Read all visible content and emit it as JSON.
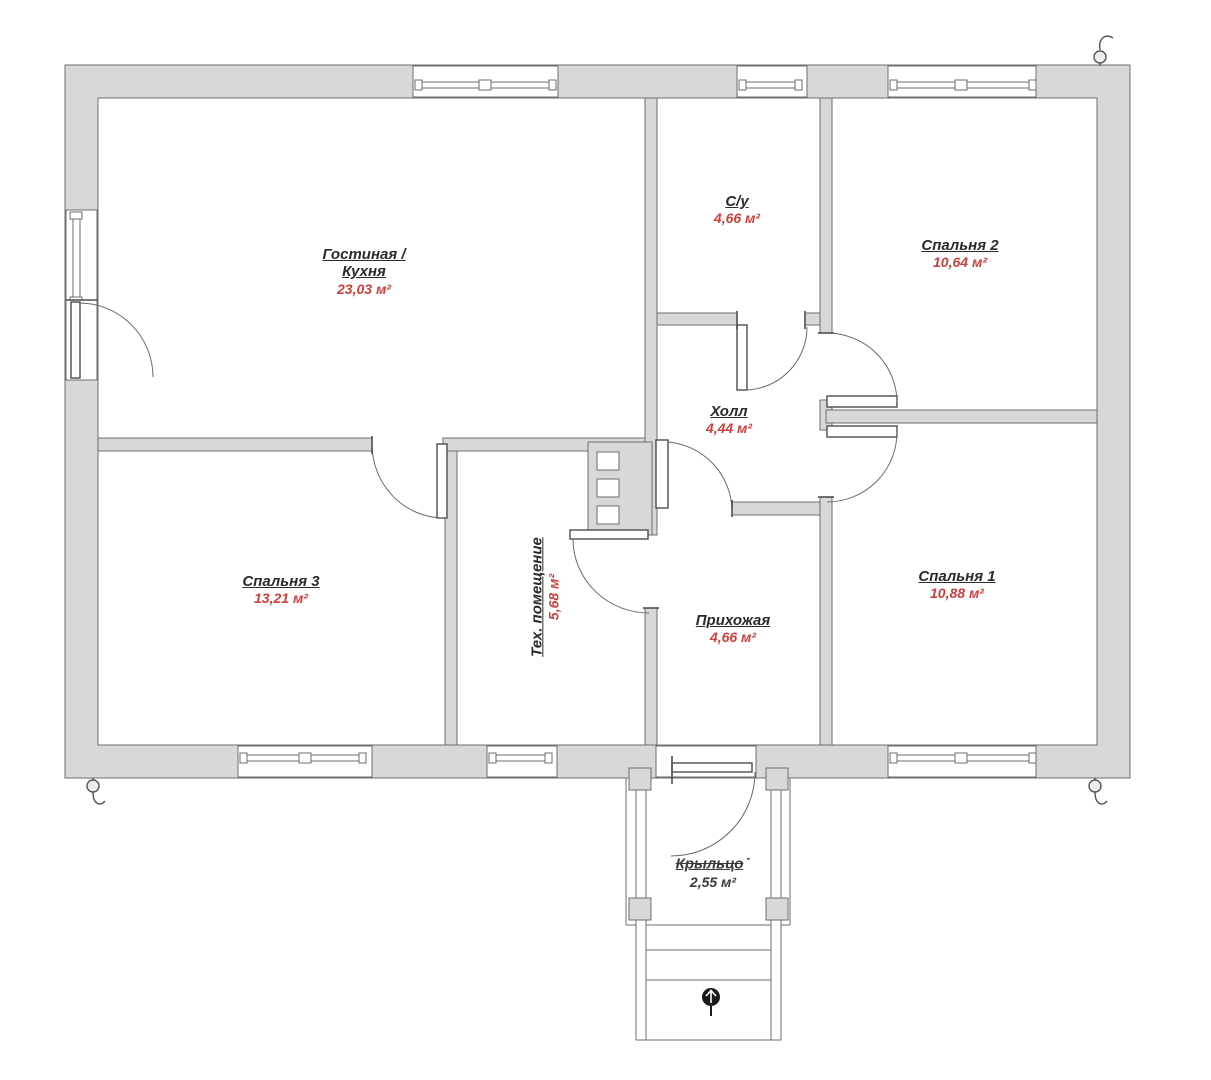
{
  "colors": {
    "wall_fill": "#d8d8d8",
    "wall_stroke": "#6e6e6e",
    "area_text": "#c9413e",
    "label_text": "#2b2b2b",
    "porch_text": "#3a3a3a"
  },
  "rooms": {
    "living": {
      "name_line1": "Гостиная /",
      "name_line2": "Кухня",
      "area": "23,03 м²"
    },
    "bathroom": {
      "name": "С/у",
      "area": "4,66 м²"
    },
    "bedroom2": {
      "name": "Спальня 2",
      "area": "10,64 м²"
    },
    "hall": {
      "name": "Холл",
      "area": "4,44 м²"
    },
    "bedroom3": {
      "name": "Спальня 3",
      "area": "13,21 м²"
    },
    "tech": {
      "name": "Тех. помещение",
      "area": "5,68 м²"
    },
    "entry": {
      "name": "Прихожая",
      "area": "4,66 м²"
    },
    "bedroom1": {
      "name": "Спальня 1",
      "area": "10,88 м²"
    },
    "porch": {
      "name": "Крыльцо",
      "suffix": "-",
      "area": "2,55 м²"
    }
  }
}
